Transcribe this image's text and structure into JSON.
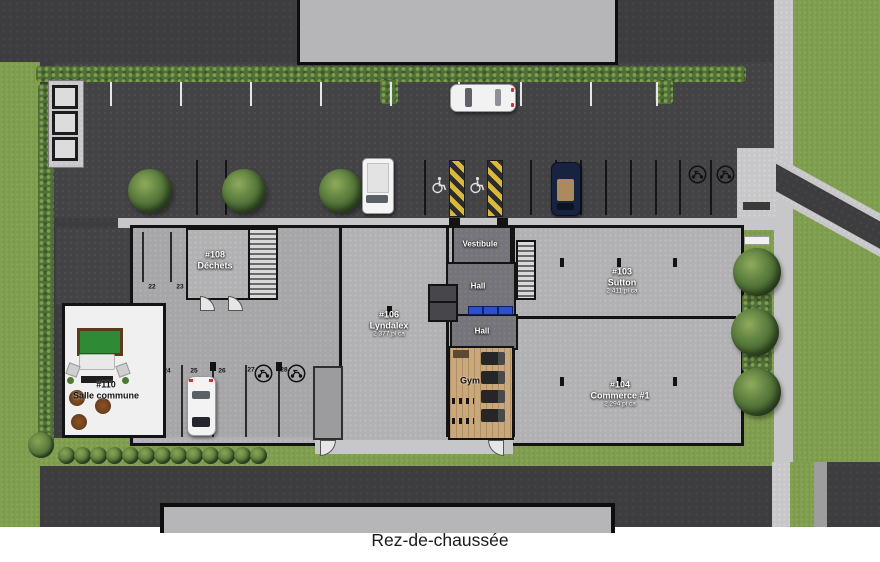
{
  "caption": "Rez-de-chaussée",
  "rooms": {
    "dechets": {
      "number": "#108",
      "name": "Déchets"
    },
    "lyndalex": {
      "number": "#106",
      "name": "Lyndalex",
      "area": "2 377 pi ca"
    },
    "sutton": {
      "number": "#103",
      "name": "Sutton",
      "area": "2 411 pi ca"
    },
    "commerce": {
      "number": "#104",
      "name": "Commerce #1",
      "area": "2 294 pi ca"
    },
    "salle_commune": {
      "number": "#110",
      "name": "Salle commune"
    },
    "vestibule": "Vestibule",
    "hall_upper": "Hall",
    "hall_lower": "Hall",
    "gym": "Gym"
  },
  "parking": {
    "stalls": {
      "s22": "22",
      "s23": "23",
      "s24": "24",
      "s25": "25",
      "s26": "26",
      "s27": "27",
      "s28": "28"
    }
  },
  "colors": {
    "grass": "#7b9a4a",
    "asphalt": "#3d3d40",
    "building_floor": "#b1b1b3",
    "accessible_hatch_yellow": "#d9ba3b",
    "mailbox_blue": "#2d50c8"
  }
}
